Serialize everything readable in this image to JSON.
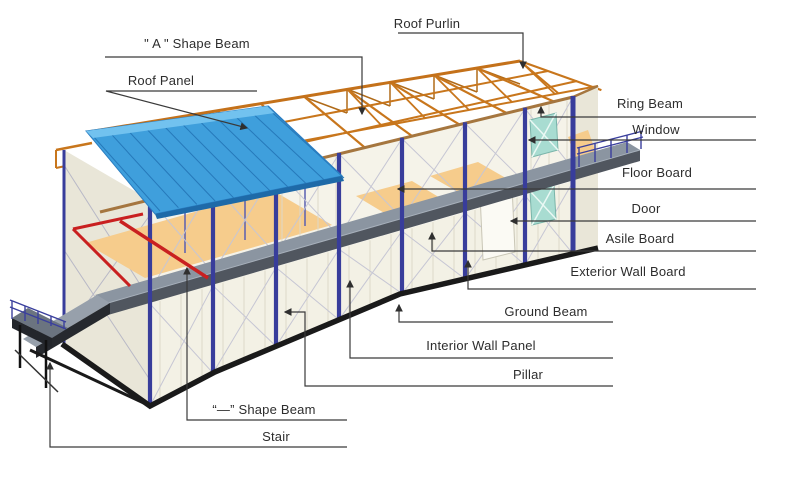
{
  "diagram": {
    "type": "annotated isometric drawing of a two-storey prefabricated steel-frame house",
    "background": "#ffffff",
    "labels": [
      {
        "id": "roof-purlin",
        "text": "Roof Purlin"
      },
      {
        "id": "a-shape-beam",
        "text": "\" A \" Shape Beam"
      },
      {
        "id": "roof-panel",
        "text": "Roof Panel"
      },
      {
        "id": "ring-beam",
        "text": "Ring Beam"
      },
      {
        "id": "window",
        "text": "Window"
      },
      {
        "id": "floor-board",
        "text": "Floor Board"
      },
      {
        "id": "door",
        "text": "Door"
      },
      {
        "id": "asile-board",
        "text": "Asile Board"
      },
      {
        "id": "exterior-wall-board",
        "text": "Exterior Wall Board"
      },
      {
        "id": "ground-beam",
        "text": "Ground Beam"
      },
      {
        "id": "interior-wall-panel",
        "text": "Interior Wall Panel"
      },
      {
        "id": "pillar",
        "text": "Pillar"
      },
      {
        "id": "flat-shape-beam",
        "text": "“—” Shape Beam"
      },
      {
        "id": "stair",
        "text": "Stair"
      }
    ],
    "colors": {
      "roof_panel": "#3f9fdc",
      "roof_ridge_cap": "#72c2ef",
      "roof_fascia": "#1e6aa8",
      "roof_truss": "#c8761c",
      "eave_ring_beam": "#a5763f",
      "pillar": "#383d9b",
      "wall": "#f3f1e5",
      "end_wall": "#e9e6d8",
      "floor_board": "#f6cc8c",
      "aisle_board": "#8b95a1",
      "ground_beam": "#1a1a1a",
      "window": "#a8dcd1",
      "flat_red_beam": "#c92020",
      "brace": "#c6c6d4",
      "leader_line": "#3a3a3a",
      "label_text": "#2d2d2d"
    }
  }
}
